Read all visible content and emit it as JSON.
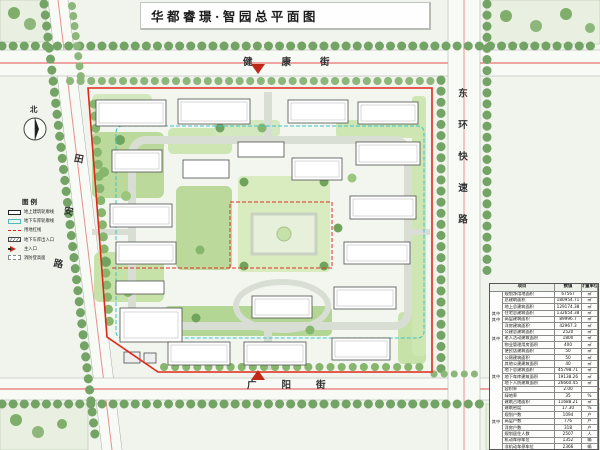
{
  "title": "华都睿璟·智园总平面图",
  "north": {
    "label": "北"
  },
  "streets": {
    "top": "健康街",
    "right": "东环快速路",
    "left": "田安路",
    "bottom": "广阳街"
  },
  "legend": {
    "title": "图例",
    "items": [
      {
        "label": "地上建筑轮廓线",
        "symbol": "black-outline-rect"
      },
      {
        "label": "地下车库轮廓线",
        "symbol": "cyan-rect"
      },
      {
        "label": "用地红线",
        "symbol": "red-dashed-line"
      },
      {
        "label": "地下车库出入口",
        "symbol": "hatched-rect"
      },
      {
        "label": "主入口",
        "symbol": "red-arrow"
      },
      {
        "label": "消防登高面",
        "symbol": "gray-dashed-rect"
      }
    ]
  },
  "table": {
    "headers": {
      "item": "项目",
      "value": "数值",
      "unit": "计量单位"
    },
    "rows": [
      {
        "g": "",
        "label": "规划净用地面积",
        "value": "67567",
        "unit": "㎡"
      },
      {
        "g": "",
        "label": "总建筑面积",
        "value": "180954.71",
        "unit": "㎡"
      },
      {
        "g": "",
        "label": "地上总建筑面积",
        "value": "129174.38",
        "unit": "㎡"
      },
      {
        "g": "其中",
        "label": "住宅总建筑面积",
        "value": "132654.38",
        "unit": "㎡"
      },
      {
        "g": "其中",
        "label": "高层建筑面积",
        "value": "89996.7",
        "unit": "㎡"
      },
      {
        "g": "",
        "label": "洋房建筑面积",
        "value": "42967.3",
        "unit": "㎡"
      },
      {
        "g": "",
        "label": "公建总建筑面积",
        "value": "2520",
        "unit": "㎡"
      },
      {
        "g": "其中",
        "label": "老人活动建筑面积",
        "value": "1800",
        "unit": "㎡"
      },
      {
        "g": "",
        "label": "物业管理用房面积",
        "value": "400",
        "unit": "㎡"
      },
      {
        "g": "",
        "label": "便民店建筑面积",
        "value": "50",
        "unit": "㎡"
      },
      {
        "g": "",
        "label": "公厕建筑面积",
        "value": "50",
        "unit": "㎡"
      },
      {
        "g": "",
        "label": "其他公建建筑面积",
        "value": "40",
        "unit": "㎡"
      },
      {
        "g": "",
        "label": "地下总建筑面积",
        "value": "45798.71",
        "unit": "㎡"
      },
      {
        "g": "其中",
        "label": "地下车库建筑面积",
        "value": "19138.26",
        "unit": "㎡"
      },
      {
        "g": "",
        "label": "地下人防建筑面积",
        "value": "26660.45",
        "unit": "㎡"
      },
      {
        "g": "",
        "label": "容积率",
        "value": "2.00",
        "unit": ""
      },
      {
        "g": "",
        "label": "绿地率",
        "value": "35",
        "unit": "%"
      },
      {
        "g": "",
        "label": "建筑占地面积",
        "value": "11688.21",
        "unit": "㎡"
      },
      {
        "g": "",
        "label": "建筑密度",
        "value": "17.30",
        "unit": "%"
      },
      {
        "g": "",
        "label": "规划户数",
        "value": "1094",
        "unit": "户"
      },
      {
        "g": "其中",
        "label": "高层户数",
        "value": "776",
        "unit": "户"
      },
      {
        "g": "",
        "label": "洋房户数",
        "value": "318",
        "unit": "户"
      },
      {
        "g": "",
        "label": "规划居住人数",
        "value": "2507",
        "unit": "人"
      },
      {
        "g": "",
        "label": "机动车停车位",
        "value": "1352",
        "unit": "辆"
      },
      {
        "g": "",
        "label": "非机动车停车位",
        "value": "2366",
        "unit": "辆"
      }
    ]
  },
  "colors": {
    "boundary_red": "#e02818",
    "garage_cyan": "#38c4ca",
    "street_centerline": "#e06060",
    "tree_green": "#74a465",
    "site_green": "#bcd99c",
    "road_gray": "#d9ded5",
    "background": "#f1f4ec"
  }
}
